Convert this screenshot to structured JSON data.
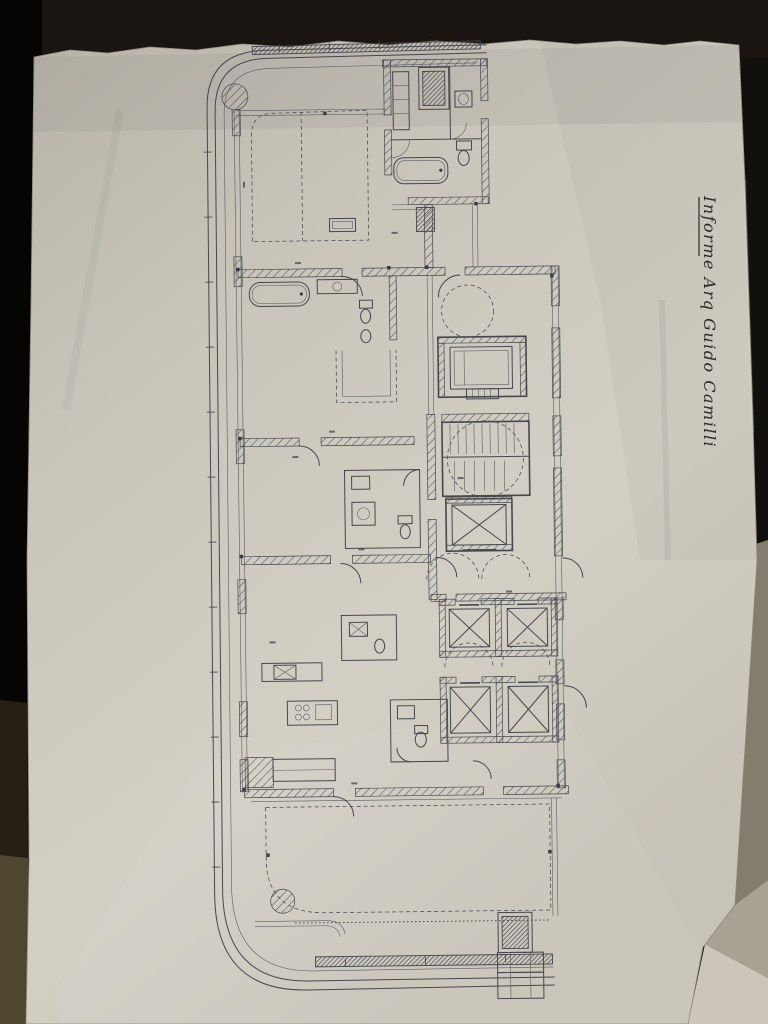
{
  "scene": {
    "description": "Photograph of an architectural floor plan drawing on a torn sheet of paper, lying on a dark surface",
    "annotation": {
      "text": "Informe Arq Guido Camilli"
    },
    "colors": {
      "background": "#0e0b08",
      "paper": "#cdc9bf",
      "ink": "#3f3f47",
      "floor_strip_brown": "#4f4630",
      "side_sheet_gray": "#847d6e",
      "under_sheet_light": "#cbc6b9"
    },
    "plan": {
      "feature_icons": [
        "curved-balcony-perimeter-icon",
        "hatched-column-icon",
        "bathtub-icon",
        "toilet-icon",
        "sink-icon",
        "kitchen-island-icon",
        "staircase-icon",
        "elevator-x-shaft-icon",
        "door-swing-arc-icon",
        "dashed-terrace-outline-icon",
        "deck-hatch-band-icon",
        "dimension-tick-icon"
      ],
      "elevator_count": 5,
      "bathtub_count": 2,
      "column_count": 2
    }
  }
}
